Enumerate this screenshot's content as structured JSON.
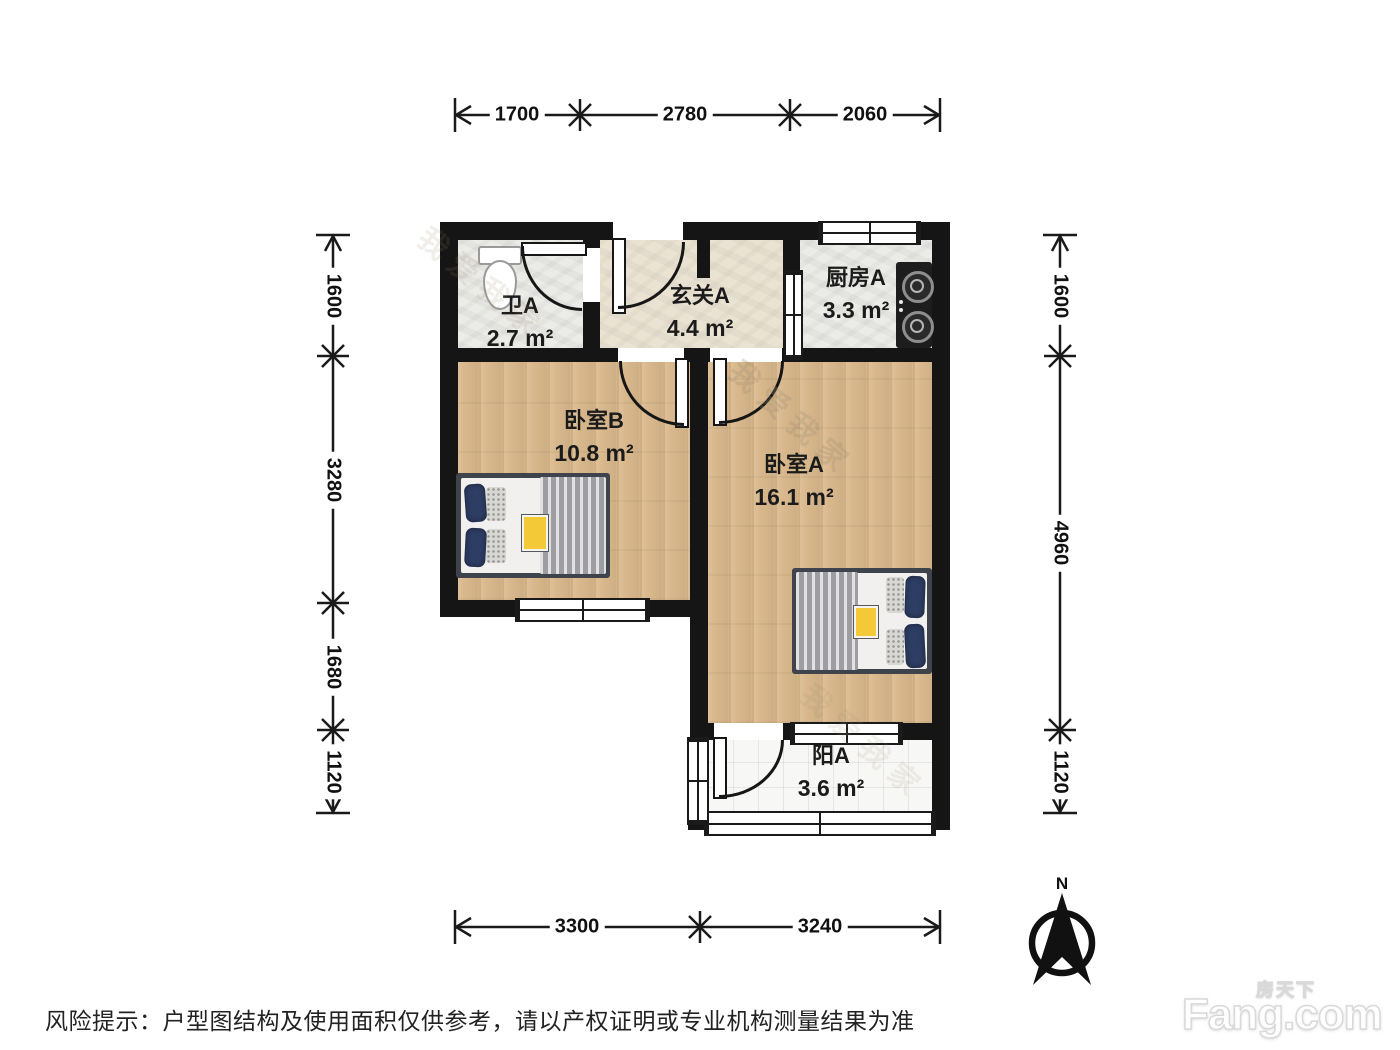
{
  "rooms": [
    {
      "name": "卫A",
      "area": "2.7 m²"
    },
    {
      "name": "玄关A",
      "area": "4.4 m²"
    },
    {
      "name": "厨房A",
      "area": "3.3 m²"
    },
    {
      "name": "卧室B",
      "area": "10.8 m²"
    },
    {
      "name": "卧室A",
      "area": "16.1 m²"
    },
    {
      "name": "阳A",
      "area": "3.6 m²"
    }
  ],
  "dimensions": {
    "top": [
      "1700",
      "2780",
      "2060"
    ],
    "bottom": [
      "3300",
      "3240"
    ],
    "left": [
      "1600",
      "3280",
      "1680",
      "1120"
    ],
    "right": [
      "1600",
      "4960",
      "1120"
    ]
  },
  "compass": {
    "label": "N"
  },
  "footer": {
    "disclaimer": "风险提示：户型图结构及使用面积仅供参考，请以产权证明或专业机构测量结果为准"
  },
  "branding": {
    "logo_text": "Fang.com",
    "logo_cn": "房天下"
  },
  "watermark": {
    "text": "我爱我家"
  },
  "colors": {
    "wall": "#151515",
    "wood_floor": "#d9b88c",
    "tile_light": "#ebebe7",
    "tile_beige": "#eae3d3",
    "balcony_tile": "#f7f7f5",
    "pillow_navy": "#2d3d63",
    "accent_yellow": "#f3c937"
  }
}
